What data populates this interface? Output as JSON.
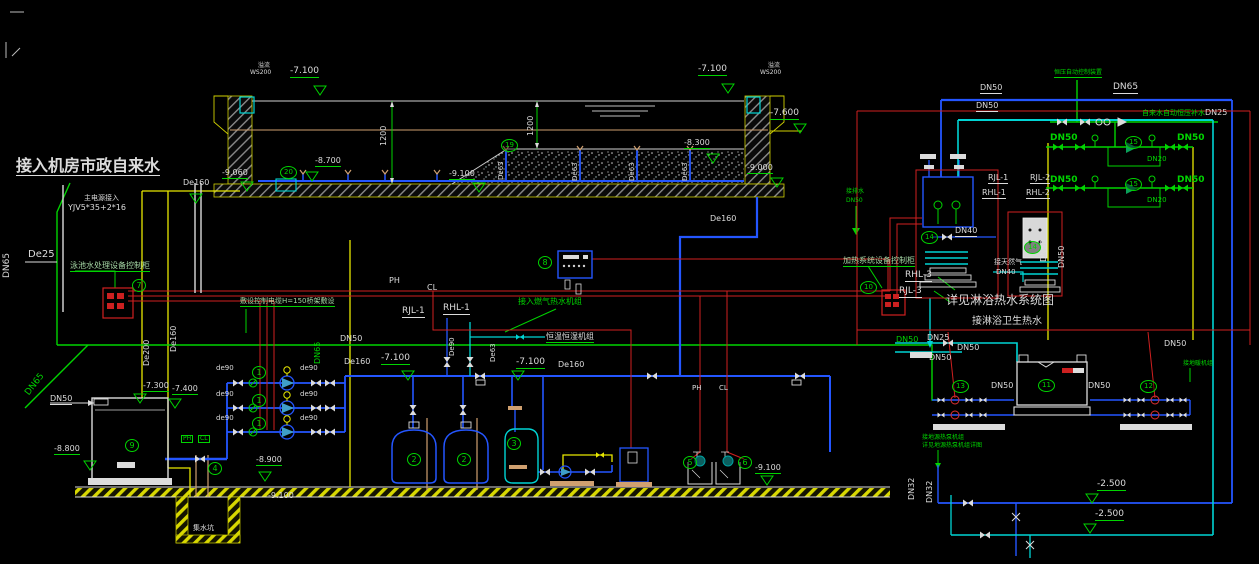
{
  "drawing": {
    "accent_colors": {
      "pipe_green": "#00d400",
      "pipe_blue": "#2456ff",
      "pipe_cyan": "#00d4d4",
      "pipe_yellow": "#e8e800",
      "annotation_white": "#dcdcdc",
      "alarm_red": "#e03030",
      "ground_tan": "#d0a070"
    },
    "labels": [
      {
        "id": "title-conn",
        "t": "接入机房市政自来水",
        "x": 16,
        "y": 158,
        "c": "w",
        "s": 16,
        "u": "w",
        "b": 1
      },
      {
        "id": "dn65-left",
        "t": "DN65",
        "x": 3,
        "y": 278,
        "c": "w",
        "s": 9,
        "r": -90
      },
      {
        "id": "de25",
        "t": "De25",
        "x": 28,
        "y": 250,
        "c": "w",
        "s": 10
      },
      {
        "id": "main-power-1",
        "t": "主电源接入",
        "x": 84,
        "y": 195,
        "c": "w",
        "s": 7
      },
      {
        "id": "main-power-2",
        "t": "YJV5*35+2*16",
        "x": 68,
        "y": 204,
        "c": "w",
        "s": 8
      },
      {
        "id": "cab7-label",
        "t": "泳池水处理设备控制柜",
        "x": 70,
        "y": 262,
        "c": "lg",
        "s": 8,
        "u": "g"
      },
      {
        "id": "cable-note",
        "t": "敷设控制电缆H=150桥架敷设",
        "x": 240,
        "y": 298,
        "c": "lg",
        "s": 7,
        "u": "g"
      },
      {
        "id": "ph-top",
        "t": "PH",
        "x": 389,
        "y": 277,
        "c": "w",
        "s": 8
      },
      {
        "id": "cl-top",
        "t": "CL",
        "x": 427,
        "y": 284,
        "c": "w",
        "s": 8
      },
      {
        "id": "de160-drain",
        "t": "De160",
        "x": 183,
        "y": 179,
        "c": "w",
        "s": 8
      },
      {
        "id": "de200-v",
        "t": "De200",
        "x": 143,
        "y": 366,
        "c": "w",
        "s": 8,
        "r": -90
      },
      {
        "id": "de160-v",
        "t": "De160",
        "x": 170,
        "y": 352,
        "c": "w",
        "s": 8,
        "r": -90
      },
      {
        "id": "dn65-mid",
        "t": "DN65",
        "x": 314,
        "y": 364,
        "c": "g",
        "s": 8,
        "r": -90
      },
      {
        "id": "dn65-diag",
        "t": "DN65",
        "x": 24,
        "y": 392,
        "c": "g",
        "s": 9,
        "r": -52
      },
      {
        "id": "dn50-tank9",
        "t": "DN50",
        "x": 50,
        "y": 395,
        "c": "w",
        "s": 8,
        "u": "w"
      },
      {
        "id": "dn50-green-mid",
        "t": "DN50",
        "x": 340,
        "y": 335,
        "c": "w",
        "s": 8
      },
      {
        "id": "de160-header-l",
        "t": "De160",
        "x": 344,
        "y": 358,
        "c": "w",
        "s": 8
      },
      {
        "id": "elev-7100-hl",
        "t": "-7.100",
        "x": 381,
        "y": 354,
        "c": "w",
        "s": 9,
        "u": "g"
      },
      {
        "id": "elev-7100-hm",
        "t": "-7.100",
        "x": 516,
        "y": 358,
        "c": "w",
        "s": 9,
        "u": "g"
      },
      {
        "id": "de160-header-m",
        "t": "De160",
        "x": 558,
        "y": 361,
        "c": "w",
        "s": 8
      },
      {
        "id": "de90-riser",
        "t": "De90",
        "x": 449,
        "y": 356,
        "c": "w",
        "s": 7,
        "r": -90
      },
      {
        "id": "de63-riser-m",
        "t": "De63",
        "x": 490,
        "y": 362,
        "c": "w",
        "s": 7,
        "r": -90
      },
      {
        "id": "rjl1-m",
        "t": "RJL-1",
        "x": 402,
        "y": 307,
        "c": "w",
        "s": 9,
        "u": "w"
      },
      {
        "id": "rhl1-m",
        "t": "RHL-1",
        "x": 443,
        "y": 304,
        "c": "w",
        "s": 9,
        "u": "w"
      },
      {
        "id": "gas-conn",
        "t": "接入燃气热水机组",
        "x": 518,
        "y": 298,
        "c": "g",
        "s": 8
      },
      {
        "id": "hengwen",
        "t": "恒温恒湿机组",
        "x": 546,
        "y": 333,
        "c": "w",
        "s": 8,
        "u": "g"
      },
      {
        "id": "overflow-l1",
        "t": "溢流",
        "x": 258,
        "y": 63,
        "c": "w",
        "s": 6
      },
      {
        "id": "overflow-l2",
        "t": "WS200",
        "x": 250,
        "y": 70,
        "c": "w",
        "s": 6
      },
      {
        "id": "elev-7100-pl",
        "t": "-7.100",
        "x": 290,
        "y": 67,
        "c": "w",
        "s": 9,
        "u": "g"
      },
      {
        "id": "elev-9060",
        "t": "-9.060",
        "x": 222,
        "y": 169,
        "c": "w",
        "s": 8,
        "u": "g"
      },
      {
        "id": "elev-8700",
        "t": "-8.700",
        "x": 315,
        "y": 157,
        "c": "w",
        "s": 8,
        "u": "g"
      },
      {
        "id": "elev-9100-pool",
        "t": "-9.100",
        "x": 449,
        "y": 170,
        "c": "w",
        "s": 8,
        "u": "g"
      },
      {
        "id": "dim-1200-a",
        "t": "1200",
        "x": 380,
        "y": 146,
        "c": "w",
        "s": 8,
        "r": -90
      },
      {
        "id": "dim-1200-b",
        "t": "1200",
        "x": 527,
        "y": 136,
        "c": "w",
        "s": 8,
        "r": -90
      },
      {
        "id": "de63-r1",
        "t": "De63",
        "x": 498,
        "y": 180,
        "c": "w",
        "s": 7,
        "r": -90
      },
      {
        "id": "de63-r2",
        "t": "De63",
        "x": 572,
        "y": 181,
        "c": "w",
        "s": 7,
        "r": -90
      },
      {
        "id": "de63-r3",
        "t": "De63",
        "x": 629,
        "y": 181,
        "c": "w",
        "s": 7,
        "r": -90
      },
      {
        "id": "de63-r4",
        "t": "De63",
        "x": 682,
        "y": 181,
        "c": "w",
        "s": 7,
        "r": -90
      },
      {
        "id": "elev-8300",
        "t": "-8.300",
        "x": 684,
        "y": 139,
        "c": "w",
        "s": 8,
        "u": "g"
      },
      {
        "id": "elev-7100-pr",
        "t": "-7.100",
        "x": 698,
        "y": 65,
        "c": "w",
        "s": 9,
        "u": "g"
      },
      {
        "id": "overflow-r1",
        "t": "溢流",
        "x": 768,
        "y": 63,
        "c": "w",
        "s": 6
      },
      {
        "id": "overflow-r2",
        "t": "WS200",
        "x": 760,
        "y": 70,
        "c": "w",
        "s": 6
      },
      {
        "id": "elev-7600",
        "t": "-7.600",
        "x": 770,
        "y": 109,
        "c": "w",
        "s": 9,
        "u": "g"
      },
      {
        "id": "elev-9000",
        "t": "-9.000",
        "x": 747,
        "y": 164,
        "c": "w",
        "s": 8,
        "u": "g"
      },
      {
        "id": "de160-riser",
        "t": "De160",
        "x": 710,
        "y": 215,
        "c": "w",
        "s": 8
      },
      {
        "id": "de90-p1l",
        "t": "de90",
        "x": 216,
        "y": 365,
        "c": "w",
        "s": 7
      },
      {
        "id": "de90-p1r",
        "t": "de90",
        "x": 300,
        "y": 365,
        "c": "w",
        "s": 7
      },
      {
        "id": "de90-p2l",
        "t": "de90",
        "x": 216,
        "y": 391,
        "c": "w",
        "s": 7
      },
      {
        "id": "de90-p2r",
        "t": "de90",
        "x": 300,
        "y": 391,
        "c": "w",
        "s": 7
      },
      {
        "id": "de90-p3l",
        "t": "de90",
        "x": 216,
        "y": 415,
        "c": "w",
        "s": 7
      },
      {
        "id": "de90-p3r",
        "t": "de90",
        "x": 300,
        "y": 415,
        "c": "w",
        "s": 7
      },
      {
        "id": "elev-7300",
        "t": "-7.300",
        "x": 143,
        "y": 382,
        "c": "w",
        "s": 8,
        "u": "g"
      },
      {
        "id": "elev-7400",
        "t": "-7.400",
        "x": 172,
        "y": 385,
        "c": "w",
        "s": 8,
        "u": "g"
      },
      {
        "id": "elev-8800",
        "t": "-8.800",
        "x": 54,
        "y": 445,
        "c": "w",
        "s": 8,
        "u": "g"
      },
      {
        "id": "elev-8900",
        "t": "-8.900",
        "x": 256,
        "y": 456,
        "c": "w",
        "s": 8,
        "u": "g"
      },
      {
        "id": "elev-9100-pit",
        "t": "-9.100",
        "x": 268,
        "y": 492,
        "c": "w",
        "s": 8
      },
      {
        "id": "elev-9100-r",
        "t": "-9.100",
        "x": 755,
        "y": 464,
        "c": "w",
        "s": 8,
        "u": "g"
      },
      {
        "id": "ph-box",
        "t": "PH",
        "x": 181,
        "y": 435,
        "c": "g",
        "s": 6,
        "bx": 1
      },
      {
        "id": "cl-box",
        "t": "CL",
        "x": 198,
        "y": 435,
        "c": "g",
        "s": 6,
        "bx": 1
      },
      {
        "id": "ph-probe",
        "t": "PH",
        "x": 692,
        "y": 385,
        "c": "w",
        "s": 7
      },
      {
        "id": "cl-probe",
        "t": "CL",
        "x": 719,
        "y": 385,
        "c": "w",
        "s": 7
      },
      {
        "id": "sump",
        "t": "集水坑",
        "x": 193,
        "y": 525,
        "c": "w",
        "s": 7
      },
      {
        "id": "dn50-t1",
        "t": "DN50",
        "x": 980,
        "y": 84,
        "c": "w",
        "s": 8,
        "u": "w"
      },
      {
        "id": "dn50-t2",
        "t": "DN50",
        "x": 976,
        "y": 102,
        "c": "w",
        "s": 8,
        "u": "w"
      },
      {
        "id": "dn65-tr",
        "t": "DN65",
        "x": 1113,
        "y": 83,
        "c": "w",
        "s": 9,
        "u": "w"
      },
      {
        "id": "press-device",
        "t": "恒压自动控制装置",
        "x": 1054,
        "y": 70,
        "c": "g",
        "s": 6,
        "u": "g"
      },
      {
        "id": "makeup",
        "t": "自来水自动恒压补水",
        "x": 1142,
        "y": 110,
        "c": "g",
        "s": 7
      },
      {
        "id": "dn25-makeup",
        "t": "DN25",
        "x": 1205,
        "y": 109,
        "c": "w",
        "s": 8
      },
      {
        "id": "dn50-g1",
        "t": "DN50",
        "x": 1050,
        "y": 134,
        "c": "g",
        "s": 9,
        "b": 1
      },
      {
        "id": "dn50-g2",
        "t": "DN50",
        "x": 1177,
        "y": 134,
        "c": "g",
        "s": 9,
        "b": 1
      },
      {
        "id": "dn20-g1",
        "t": "DN20",
        "x": 1147,
        "y": 156,
        "c": "g",
        "s": 7
      },
      {
        "id": "dn50-g3",
        "t": "DN50",
        "x": 1050,
        "y": 176,
        "c": "g",
        "s": 9,
        "b": 1
      },
      {
        "id": "dn50-g4",
        "t": "DN50",
        "x": 1177,
        "y": 176,
        "c": "g",
        "s": 9,
        "b": 1
      },
      {
        "id": "dn20-g2",
        "t": "DN20",
        "x": 1147,
        "y": 197,
        "c": "g",
        "s": 7
      },
      {
        "id": "rjl1-r",
        "t": "RJL-1",
        "x": 988,
        "y": 174,
        "c": "w",
        "s": 8,
        "u": "w"
      },
      {
        "id": "rhl1-r",
        "t": "RHL-1",
        "x": 982,
        "y": 189,
        "c": "w",
        "s": 8,
        "u": "w"
      },
      {
        "id": "rjl2-r",
        "t": "RJL-2",
        "x": 1030,
        "y": 174,
        "c": "w",
        "s": 8,
        "u": "w"
      },
      {
        "id": "rhl2-r",
        "t": "RHL-2",
        "x": 1026,
        "y": 189,
        "c": "w",
        "s": 8,
        "u": "w"
      },
      {
        "id": "dn40-hx",
        "t": "DN40",
        "x": 955,
        "y": 227,
        "c": "w",
        "s": 8,
        "u": "w"
      },
      {
        "id": "gas-label-1",
        "t": "接天然气",
        "x": 994,
        "y": 259,
        "c": "w",
        "s": 7
      },
      {
        "id": "gas-label-2",
        "t": "DN40",
        "x": 996,
        "y": 269,
        "c": "w",
        "s": 7
      },
      {
        "id": "dn50-v1",
        "t": "DN50",
        "x": 1040,
        "y": 262,
        "c": "w",
        "s": 8,
        "r": -90
      },
      {
        "id": "dn50-v2",
        "t": "DN50",
        "x": 1058,
        "y": 268,
        "c": "w",
        "s": 8,
        "r": -90
      },
      {
        "id": "cab10-label",
        "t": "加热系统设备控制柜",
        "x": 843,
        "y": 257,
        "c": "lg",
        "s": 8,
        "u": "g"
      },
      {
        "id": "rhl3",
        "t": "RHL-3",
        "x": 905,
        "y": 271,
        "c": "w",
        "s": 9,
        "u": "w"
      },
      {
        "id": "rjl3",
        "t": "RJL-3",
        "x": 899,
        "y": 287,
        "c": "w",
        "s": 9,
        "u": "w"
      },
      {
        "id": "see-shower",
        "t": "详见淋浴热水系统图",
        "x": 946,
        "y": 294,
        "c": "w",
        "s": 12
      },
      {
        "id": "shower-conn",
        "t": "接淋浴卫生热水",
        "x": 972,
        "y": 317,
        "c": "w",
        "s": 10
      },
      {
        "id": "dn25-shower",
        "t": "DN25",
        "x": 927,
        "y": 334,
        "c": "w",
        "s": 8
      },
      {
        "id": "dn50-r1",
        "t": "DN50",
        "x": 896,
        "y": 336,
        "c": "g",
        "s": 8
      },
      {
        "id": "dn50-r2",
        "t": "DN50",
        "x": 957,
        "y": 344,
        "c": "w",
        "s": 8
      },
      {
        "id": "dn50-r3",
        "t": "DN50",
        "x": 929,
        "y": 354,
        "c": "w",
        "s": 8
      },
      {
        "id": "dn50-r4",
        "t": "DN50",
        "x": 991,
        "y": 382,
        "c": "w",
        "s": 8
      },
      {
        "id": "dn50-r5",
        "t": "DN50",
        "x": 1088,
        "y": 382,
        "c": "w",
        "s": 8
      },
      {
        "id": "dn50-r6",
        "t": "DN50",
        "x": 1164,
        "y": 340,
        "c": "w",
        "s": 8
      },
      {
        "id": "floor-heat",
        "t": "接地暖机组",
        "x": 1183,
        "y": 361,
        "c": "g",
        "s": 6
      },
      {
        "id": "gshp-1",
        "t": "接地源热泵机组",
        "x": 922,
        "y": 435,
        "c": "g",
        "s": 6
      },
      {
        "id": "gshp-2",
        "t": "详见地源热泵机组详图",
        "x": 922,
        "y": 443,
        "c": "g",
        "s": 6
      },
      {
        "id": "dn32-a",
        "t": "DN32",
        "x": 908,
        "y": 500,
        "c": "w",
        "s": 8,
        "r": -90
      },
      {
        "id": "dn32-b",
        "t": "DN32",
        "x": 926,
        "y": 503,
        "c": "w",
        "s": 8,
        "r": -90
      },
      {
        "id": "elev-2500-a",
        "t": "-2.500",
        "x": 1097,
        "y": 480,
        "c": "w",
        "s": 9,
        "u": "g"
      },
      {
        "id": "elev-2500-b",
        "t": "-2.500",
        "x": 1095,
        "y": 510,
        "c": "w",
        "s": 9,
        "u": "g"
      },
      {
        "id": "drain-conn-1",
        "t": "接排水",
        "x": 846,
        "y": 189,
        "c": "g",
        "s": 6
      },
      {
        "id": "drain-conn-2",
        "t": "DN50",
        "x": 846,
        "y": 198,
        "c": "g",
        "s": 6
      }
    ],
    "tags": [
      {
        "n": "1",
        "x": 252,
        "y": 366
      },
      {
        "n": "1",
        "x": 252,
        "y": 394
      },
      {
        "n": "1",
        "x": 252,
        "y": 417
      },
      {
        "n": "2",
        "x": 407,
        "y": 453
      },
      {
        "n": "2",
        "x": 457,
        "y": 453
      },
      {
        "n": "3",
        "x": 507,
        "y": 437
      },
      {
        "n": "4",
        "x": 208,
        "y": 462
      },
      {
        "n": "5",
        "x": 683,
        "y": 456
      },
      {
        "n": "6",
        "x": 738,
        "y": 456
      },
      {
        "n": "7",
        "x": 132,
        "y": 279
      },
      {
        "n": "8",
        "x": 538,
        "y": 256
      },
      {
        "n": "9",
        "x": 125,
        "y": 439
      },
      {
        "n": "10",
        "x": 860,
        "y": 281
      },
      {
        "n": "11",
        "x": 1038,
        "y": 379
      },
      {
        "n": "12",
        "x": 1140,
        "y": 380
      },
      {
        "n": "13",
        "x": 952,
        "y": 380
      },
      {
        "n": "14",
        "x": 921,
        "y": 231
      },
      {
        "n": "14",
        "x": 1024,
        "y": 241
      },
      {
        "n": "15",
        "x": 1125,
        "y": 136
      },
      {
        "n": "15",
        "x": 1125,
        "y": 178
      },
      {
        "n": "19",
        "x": 501,
        "y": 139
      },
      {
        "n": "20",
        "x": 280,
        "y": 166
      }
    ],
    "elev_markers": [
      [
        320,
        95
      ],
      [
        728,
        93
      ],
      [
        800,
        133
      ],
      [
        713,
        163
      ],
      [
        777,
        187
      ],
      [
        247,
        191
      ],
      [
        312,
        181
      ],
      [
        479,
        192
      ],
      [
        196,
        203
      ],
      [
        140,
        403
      ],
      [
        175,
        408
      ],
      [
        90,
        470
      ],
      [
        265,
        481
      ],
      [
        767,
        485
      ],
      [
        518,
        380
      ],
      [
        408,
        380
      ],
      [
        1092,
        503
      ],
      [
        1090,
        533
      ]
    ]
  }
}
